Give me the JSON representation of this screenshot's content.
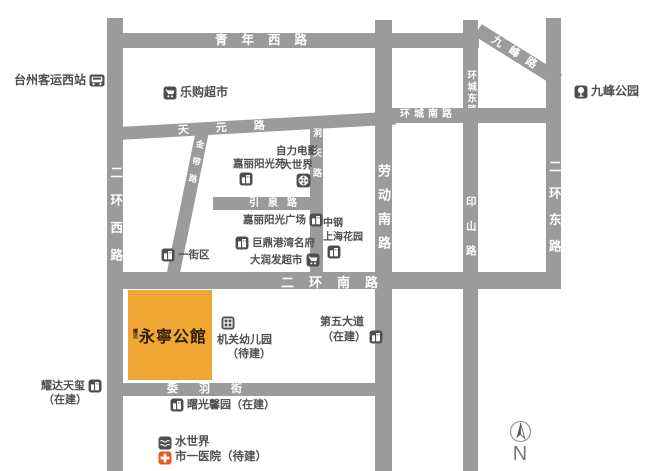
{
  "roads": {
    "qingnian_west": "青年西路",
    "erhuan_west": "二环西路",
    "erhuan_east": "二环东路",
    "erhuan_south": "二环南路",
    "jiufeng": "九峰路",
    "huancheng_east": "环城东路",
    "huancheng_south": "环城南路",
    "laodong_south": "劳动南路",
    "yinshan": "印山路",
    "tianyuan": "天元路",
    "jindai": "金带路",
    "yinquan": "引泉路",
    "dongtian": "洞天路",
    "weiyu": "委羽街"
  },
  "pois": {
    "bus_station": "台州客运西站",
    "legou": "乐购超市",
    "zili": {
      "line1": "自力电影",
      "line2": "大世界"
    },
    "jiali_yuan": "嘉丽阳光苑",
    "jiali_plaza": "嘉丽阳光广场",
    "juding": "巨鼎港湾名府",
    "darunfa": "大润发超市",
    "yijiequ": "一街区",
    "zhonggang": {
      "line1": "中钢",
      "line2": "上海花园"
    },
    "jiufeng_park": "九峰公园",
    "jiguan": {
      "line1": "机关幼儿园",
      "line2": "（待建）"
    },
    "fifth": {
      "line1": "第五大道",
      "line2": "（在建）"
    },
    "yaoda": {
      "line1": "耀达天玺",
      "line2": "（在建）"
    },
    "shuguang": "曙光馨园（在建）",
    "water_world": "水世界",
    "hospital": "市一医院（待建）"
  },
  "project": {
    "brand_mark_top": "耀",
    "brand_mark_bottom": "达",
    "name": "永寧公館"
  },
  "compass": {
    "north_label": "N"
  },
  "colors": {
    "road": "#9b9b9b",
    "road_label": "#ffffff",
    "poi_text": "#4f4f4f",
    "icon_bg": "#4e4e4e",
    "project_bg": "#f0a632",
    "project_text": "#2b1d06",
    "hospital_icon": "#e8561f"
  }
}
